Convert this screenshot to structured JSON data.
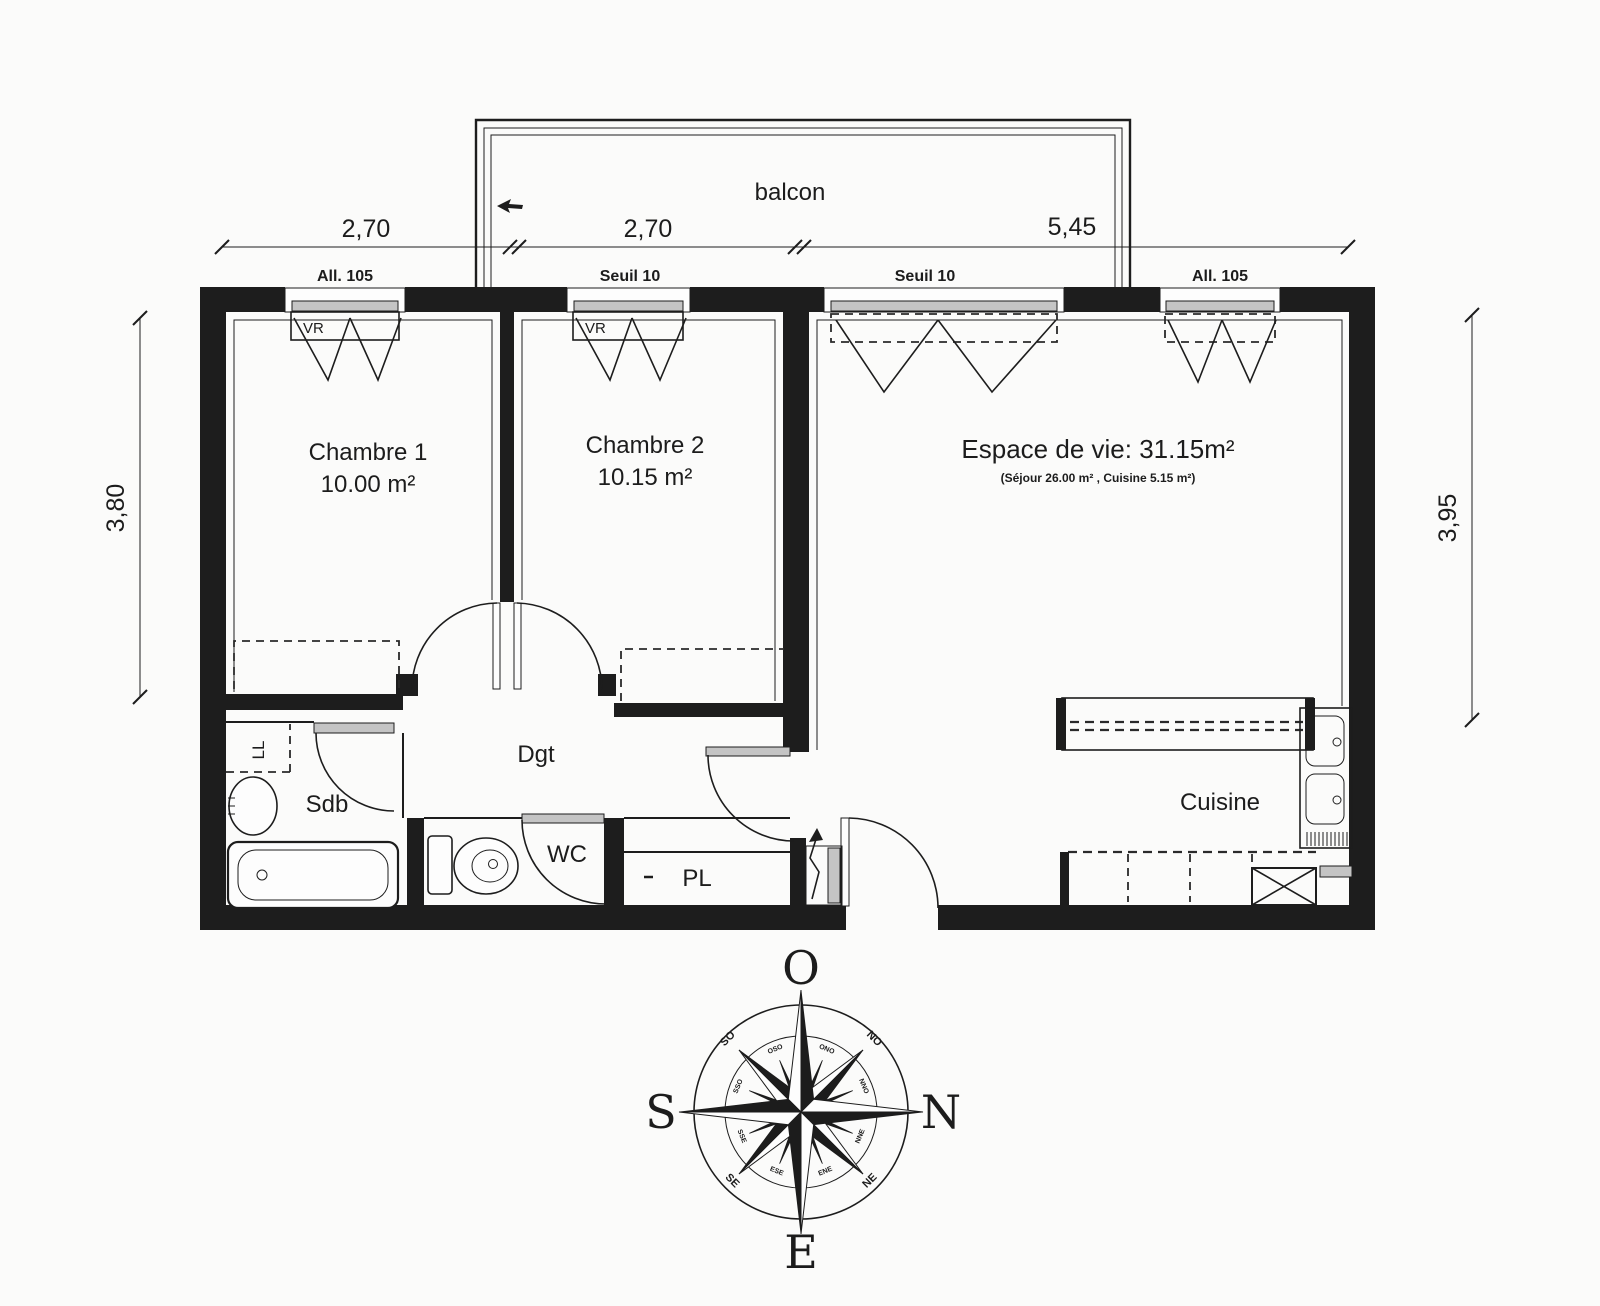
{
  "colors": {
    "ink": "#1d1d1d",
    "paper": "#fbfbfa",
    "hatch_grey": "#c4c4c4"
  },
  "balcony": {
    "label": "balcon"
  },
  "dimensions": {
    "top": [
      {
        "value": "2,70"
      },
      {
        "value": "2,70"
      },
      {
        "value": "5,45"
      }
    ],
    "left": {
      "value": "3,80"
    },
    "right": {
      "value": "3,95"
    }
  },
  "windows": [
    {
      "label": "All. 105",
      "shutter": "VR"
    },
    {
      "label": "Seuil 10",
      "shutter": "VR"
    },
    {
      "label": "Seuil 10",
      "shutter": ""
    },
    {
      "label": "All. 105",
      "shutter": ""
    }
  ],
  "rooms": {
    "chambre1": {
      "name": "Chambre 1",
      "area": "10.00 m²"
    },
    "chambre2": {
      "name": "Chambre 2",
      "area": "10.15 m²"
    },
    "living": {
      "name": "Espace de vie: 31.15m²",
      "detail": "(Séjour 26.00 m² , Cuisine 5.15 m²)"
    },
    "kitchen": {
      "name": "Cuisine"
    },
    "bathroom": {
      "name": "Sdb"
    },
    "wc": {
      "name": "WC"
    },
    "hallway": {
      "name": "Dgt"
    },
    "closet": {
      "name": "PL"
    },
    "washing_machine": {
      "name": "LL"
    }
  },
  "compass": {
    "cardinals": {
      "top": "O",
      "right": "N",
      "bottom": "E",
      "left": "S"
    },
    "intercardinals": {
      "upper_left": "SO",
      "upper_right": "NO",
      "lower_left": "SE",
      "lower_right": "NE"
    },
    "minor": {
      "ono": "ONO",
      "nno": "NNO",
      "nne": "NNE",
      "ene": "ENE",
      "ese": "ESE",
      "sse": "SSE",
      "sso": "SSO",
      "oso": "OSO"
    }
  }
}
